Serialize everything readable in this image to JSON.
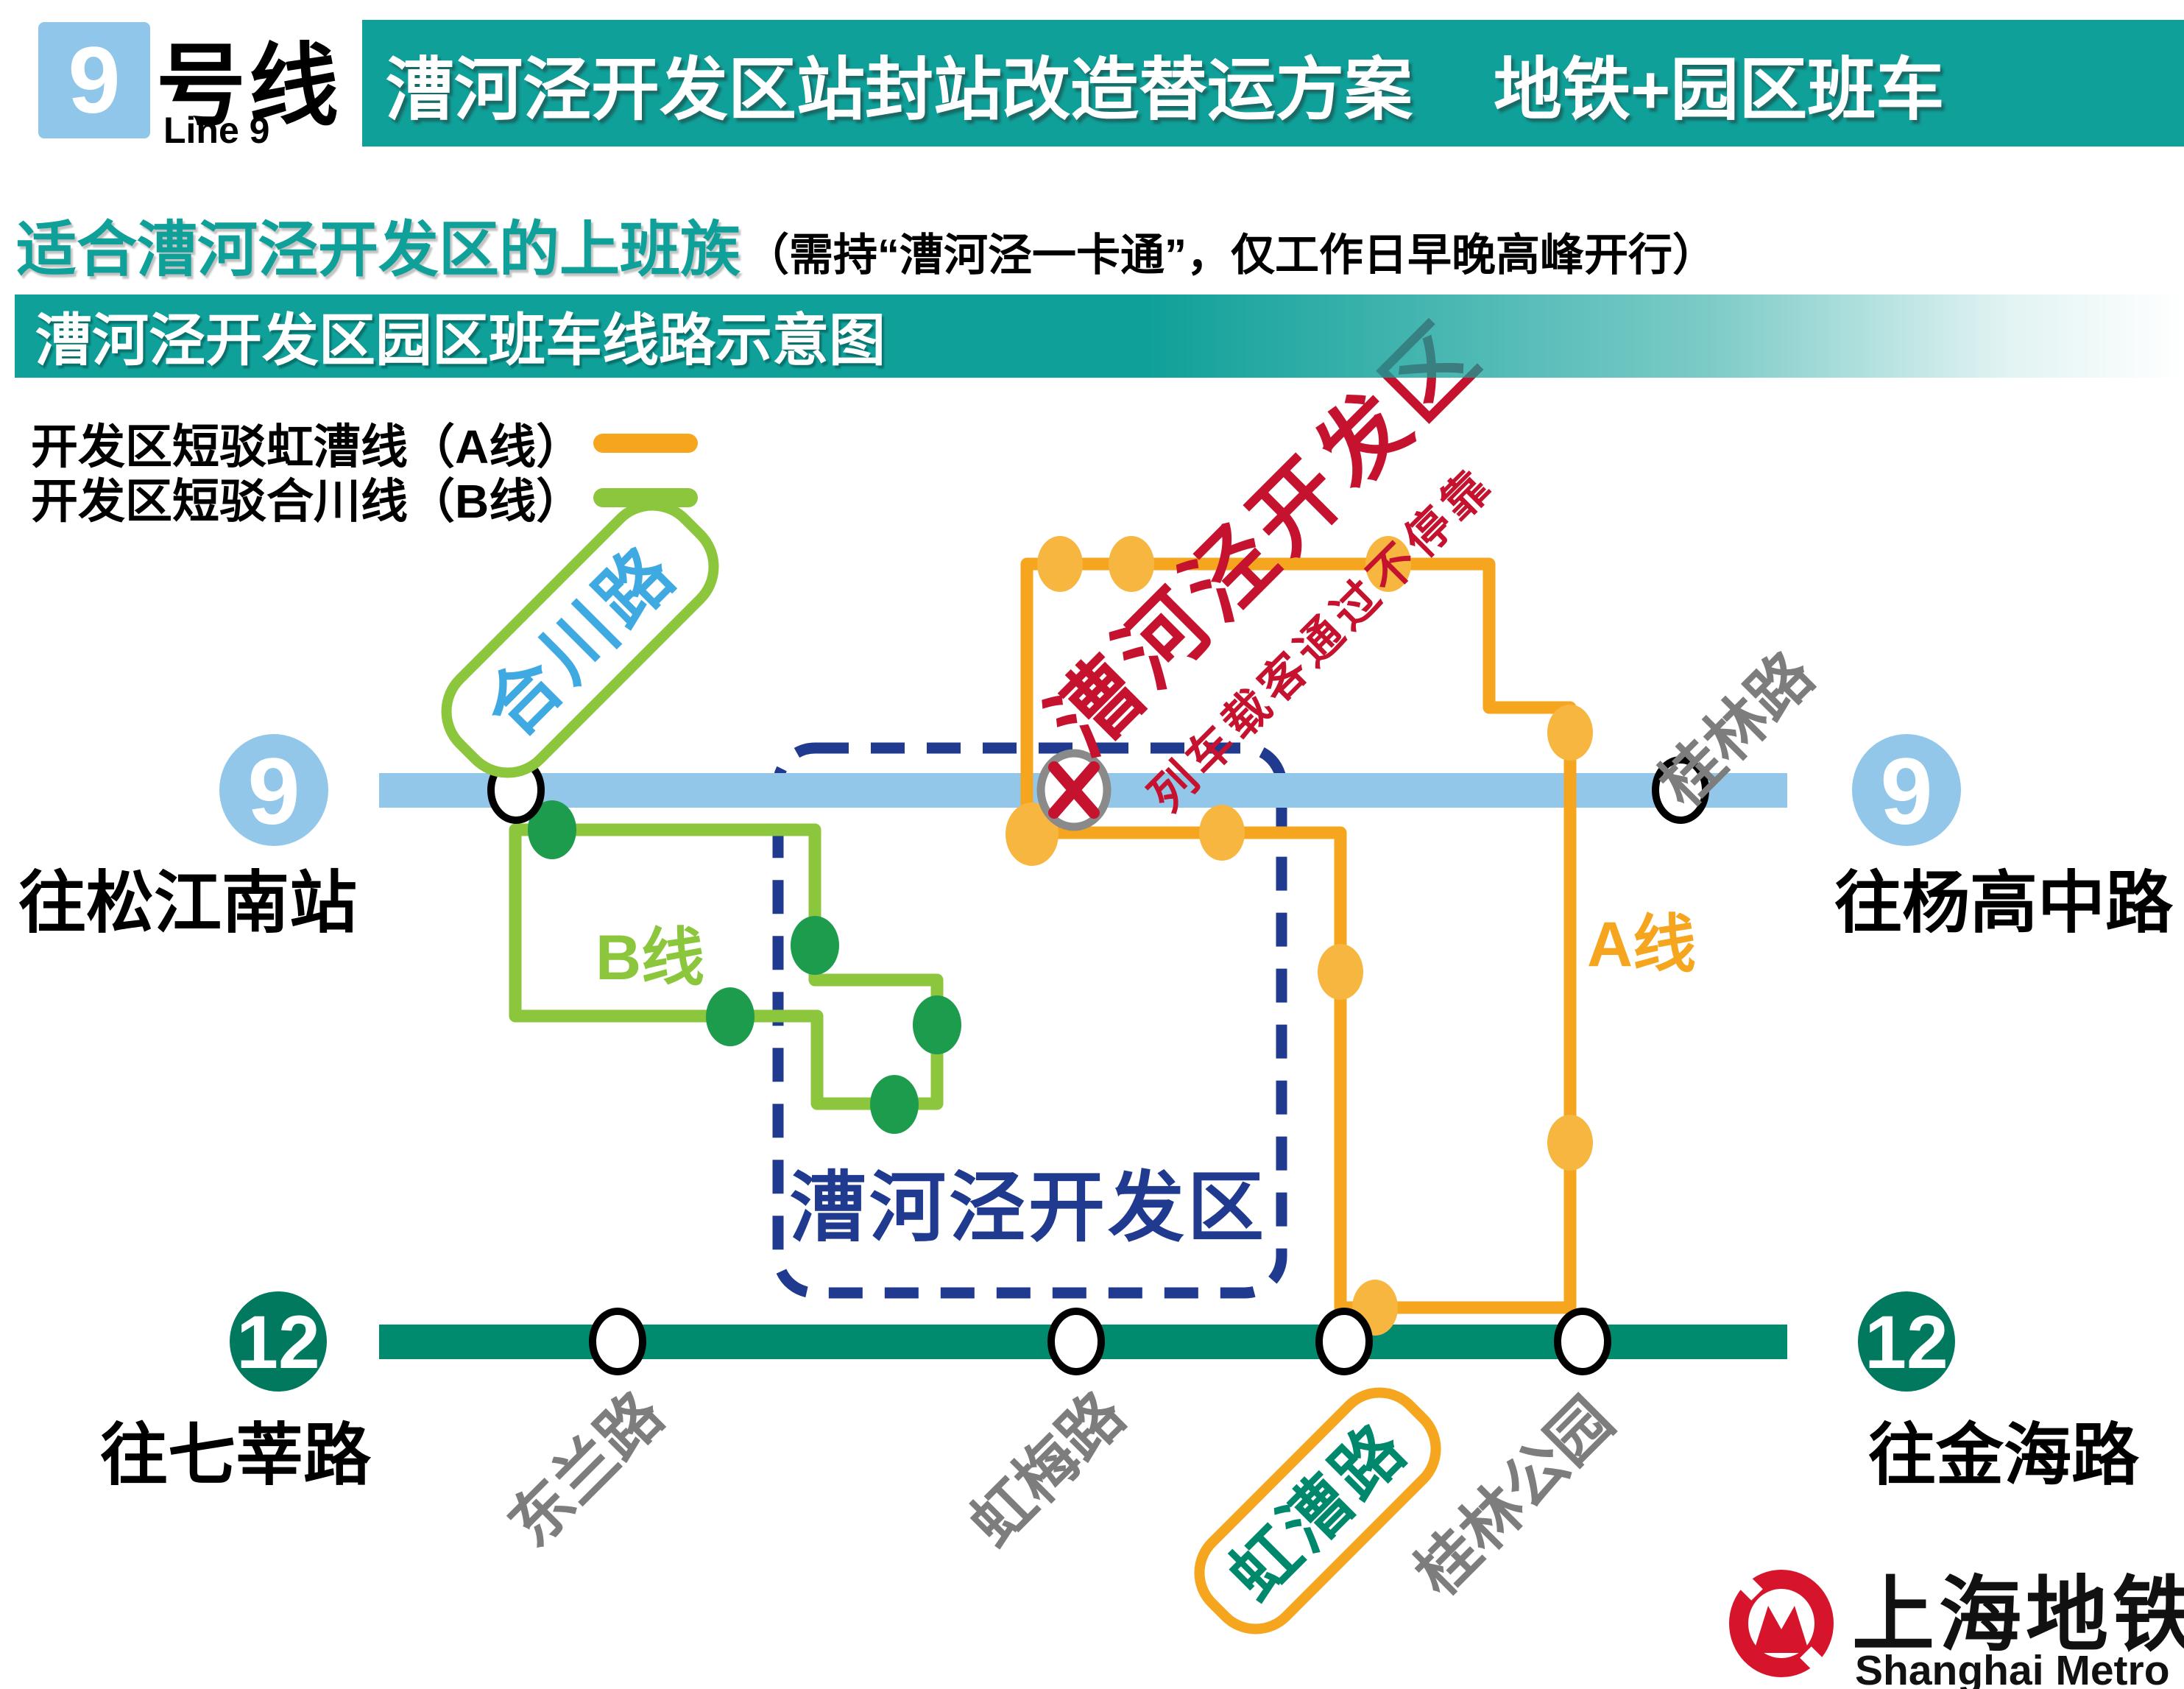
{
  "header": {
    "line_badge": "9",
    "line_name": "号线",
    "line_name_en": "Line 9",
    "title_main": "漕河泾开发区站封站改造替运方案",
    "title_tag": "地铁+园区班车"
  },
  "subtitle": {
    "lead": "适合漕河泾开发区的上班族",
    "paren": "（需持“漕河泾一卡通”，仅工作日早晚高峰开行）"
  },
  "section_banner": "漕河泾开发区园区班车线路示意图",
  "legend": {
    "a": {
      "label": "开发区短驳虹漕线（A线）",
      "color": "#F6A51F"
    },
    "b": {
      "label": "开发区短驳合川线（B线）",
      "color": "#8CC63D"
    }
  },
  "map": {
    "line9": {
      "badge": "9",
      "terminus_left": "往松江南站",
      "terminus_right": "往杨高中路",
      "color": "#92C7EA"
    },
    "line12": {
      "badge": "12",
      "terminus_left": "往七莘路",
      "terminus_right": "往金海路",
      "color": "#008A6E"
    },
    "stations_line9": {
      "hechuanlu": "合川路",
      "caohejing": "漕河泾开发区",
      "guilinlu": "桂林路"
    },
    "stations_line12": {
      "donglanlu": "东兰路",
      "hongmeilu": "虹梅路",
      "hongcaolu": "虹漕路",
      "guilin_park": "桂林公园"
    },
    "route_a_label": "A线",
    "route_b_label": "B线",
    "zone_label": "漕河泾开发区",
    "closed_station_name": "漕河泾开发区",
    "closed_station_note": "列车载客通过不停靠"
  },
  "logo": {
    "zh": "上海地铁",
    "en": "Shanghai Metro"
  },
  "colors": {
    "teal": "#0FA099",
    "line9_blue": "#92C7EA",
    "line12_green": "#008A6E",
    "badge12_green": "#00795F",
    "route_a_orange": "#F6A51F",
    "route_a_dot": "#F7B640",
    "route_b_green": "#8CC63D",
    "route_b_dot": "#1E9C4D",
    "zone_navy": "#203A8F",
    "alert_red": "#C4122F",
    "label_gray": "#7D7D7D",
    "hechuan_text_blue": "#3FA9E1",
    "logo_red": "#D6152C"
  }
}
